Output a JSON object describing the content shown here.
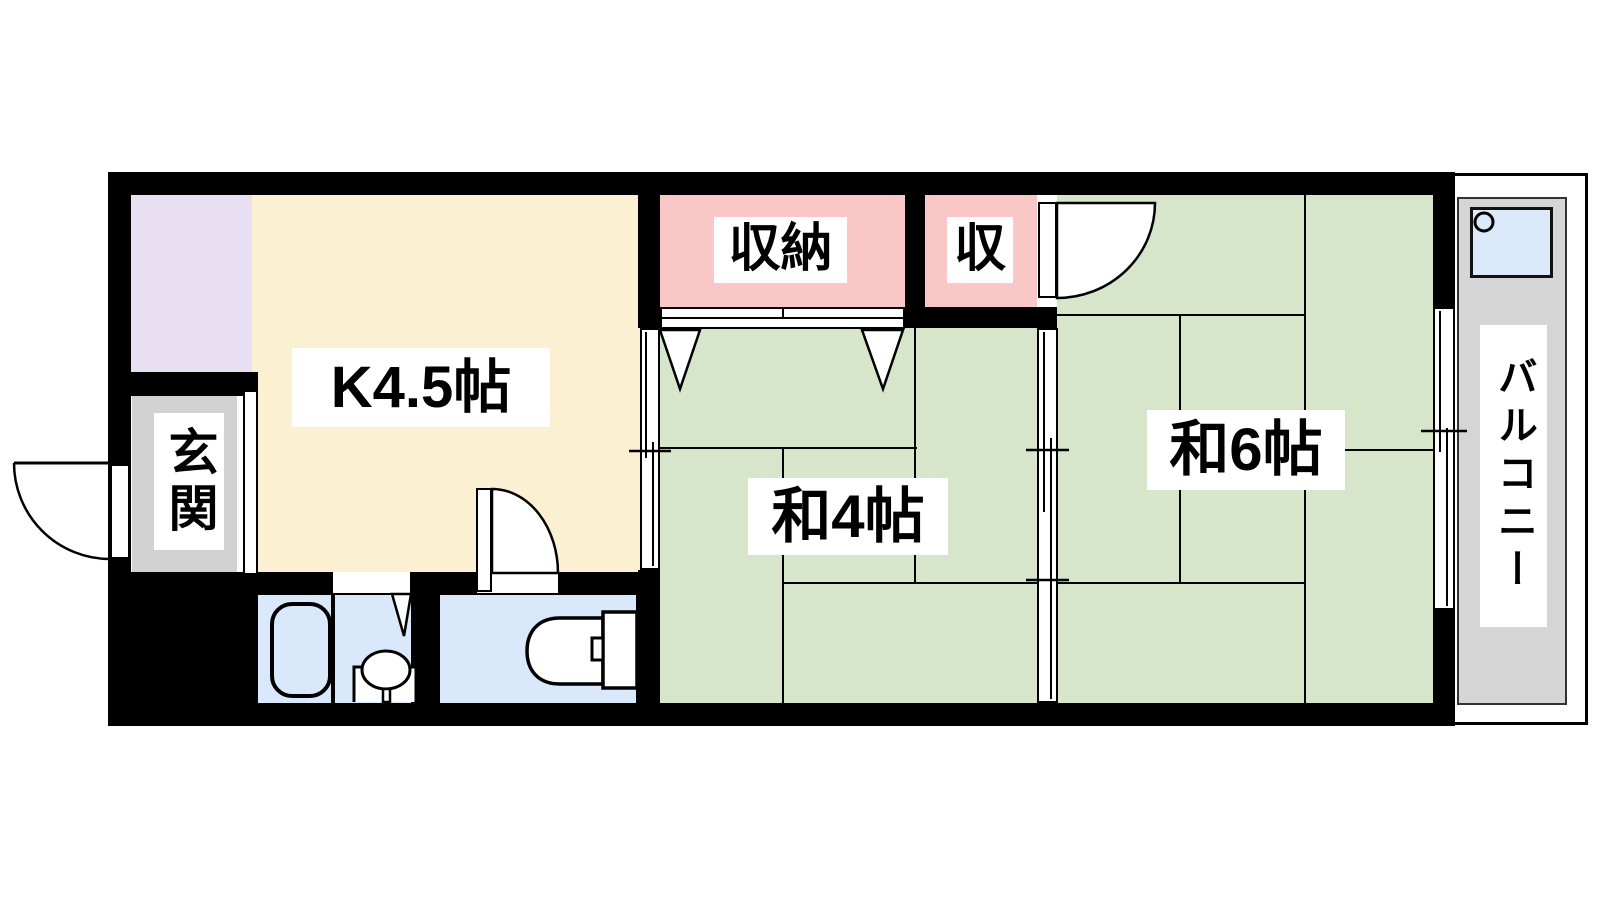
{
  "title": "1K+2和室 間取り図 (apartment floor plan)",
  "rooms": {
    "kitchen": {
      "label": "K4.5帖",
      "color": "#FBF0D2"
    },
    "entrance": {
      "label": "玄関",
      "color": "#D2D2D2"
    },
    "closet_large": {
      "label": "収納",
      "color": "#F8C7C6"
    },
    "closet_small": {
      "label": "収",
      "color": "#F8C7C6"
    },
    "washitsu4": {
      "label": "和4帖",
      "color": "#D7E6CA"
    },
    "washitsu6": {
      "label": "和6帖",
      "color": "#D7E6CA"
    },
    "balcony": {
      "label": "バルコニー",
      "color": "#D5D5D5"
    },
    "bathroom": {
      "label": "",
      "color": "#E8DFF3"
    },
    "sanitary": {
      "label": "",
      "color": "#D9E8FA"
    }
  },
  "palette": {
    "wall": "#000000",
    "tatami_line": "#000000",
    "fixture_fill": "#FFFFFF",
    "washer_pan": "#DBEAFB"
  },
  "fixtures": {
    "bathtub": "bathtub-icon",
    "washbasin": "washbasin-icon",
    "toilet": "toilet-icon",
    "washer_pan": "washing-machine-pan-icon",
    "closet_markers": "closet-triangle-markers",
    "doors": "door-swing-arcs",
    "sliding_partitions": "sliding-door-symbols"
  }
}
